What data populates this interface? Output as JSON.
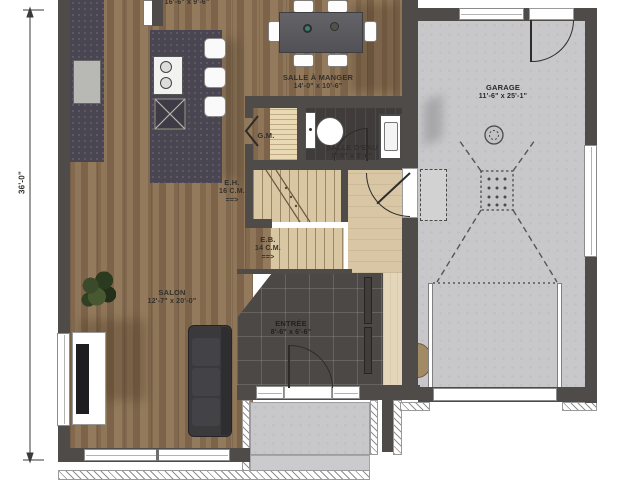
{
  "labels": {
    "kitchen_dims": "16'-6\" x 9'-6\"",
    "dining_name": "SALLE À MANGER",
    "dining_dims": "14'-0\" x 10'-6\"",
    "pantry": "G.M.",
    "powder_name": "SALLE D'EAU",
    "powder_dims": "5'-0\" x 3'-0\"",
    "stairs_up_name": "E.H.",
    "stairs_up_count": "16 C.M.",
    "stairs_up_arrow": "==>",
    "stairs_down_name": "E.B.",
    "stairs_down_count": "14 C.M.",
    "stairs_down_arrow": "==>",
    "salon_name": "SALON",
    "salon_dims": "12'-7\" x 20'-0\"",
    "entry_name": "ENTRÉE",
    "entry_dims": "8'-6\" x 6'-6\"",
    "garage_name": "GARAGE",
    "garage_dims": "11'-6\" x 25'-1\"",
    "overall_depth": "36'-0\""
  },
  "colors": {
    "wall": "#4f4b49",
    "wood_floor": "#8a7054",
    "entry_tile": "#4b4846",
    "garage_concrete": "#c8c8ca",
    "stair_wood": "#d9c7a4",
    "counter": "#494551",
    "sofa": "#3a393c",
    "label_text": "#33302c"
  }
}
